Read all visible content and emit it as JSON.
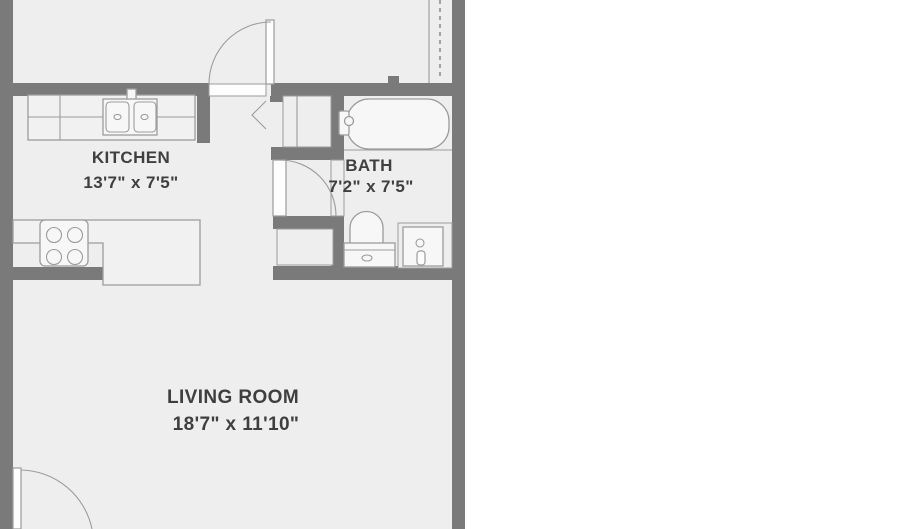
{
  "rooms": {
    "kitchen": {
      "name": "KITCHEN",
      "dims": "13'7\" x 7'5\""
    },
    "bath": {
      "name": "BATH",
      "dims": "7'2\" x 7'5\""
    },
    "living": {
      "name": "LIVING ROOM",
      "dims": "18'7\" x 11'10\""
    }
  },
  "fixtures": [
    "kitchen-double-sink",
    "kitchen-counter",
    "stove-four-burners",
    "kitchen-peninsula-counter",
    "bathtub",
    "tub-faucet",
    "toilet",
    "vanity-sink",
    "bifold-closet",
    "linen-closet",
    "hall-closet-dashed-rod",
    "entry-door-swing",
    "hall-door-swing",
    "bath-door-swing"
  ],
  "colors": {
    "wall": "#7a7a7a",
    "floor": "#eeeeef",
    "line": "#9c9c9c",
    "text": "#3f3f3f",
    "fixture": "#f7f7f8",
    "door": "#fdfdfd",
    "background": "#ffffff"
  }
}
